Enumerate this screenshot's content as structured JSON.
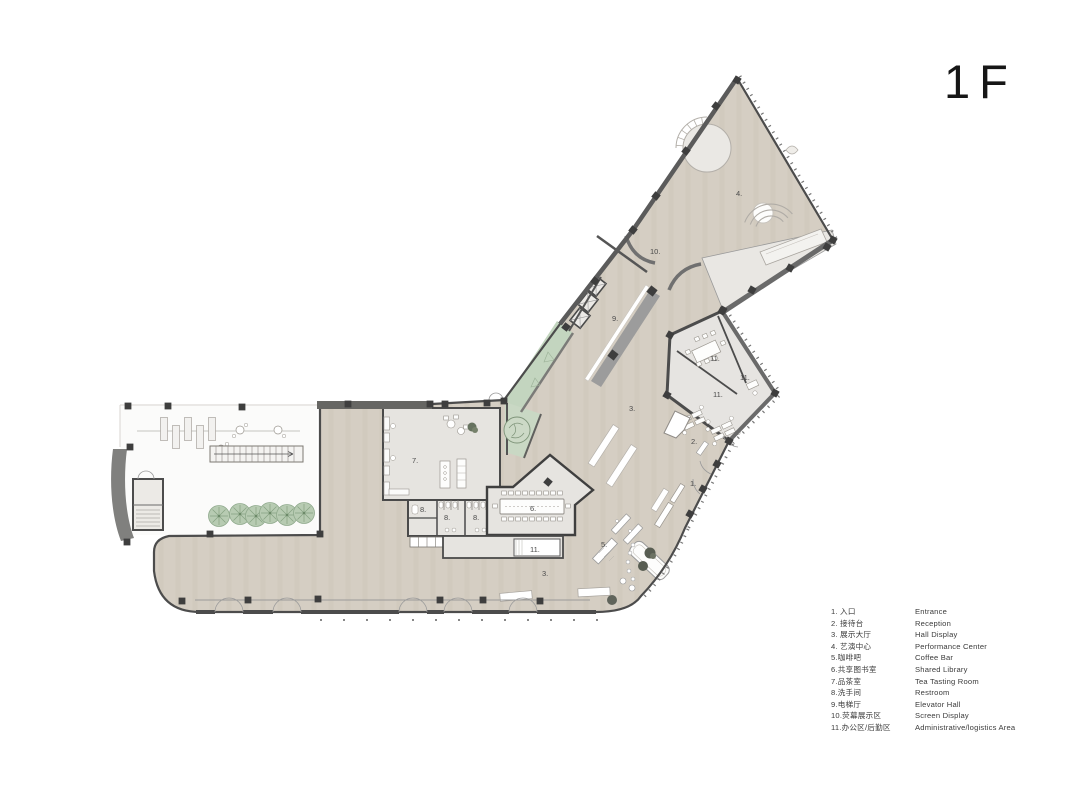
{
  "title": "1F",
  "legend": {
    "items": [
      {
        "cn": "1. 入口",
        "en": "Entrance"
      },
      {
        "cn": "2. 接待台",
        "en": "Reception"
      },
      {
        "cn": "3. 展示大厅",
        "en": "Hall Display"
      },
      {
        "cn": "4. 艺演中心",
        "en": "Performance Center"
      },
      {
        "cn": "5.咖啡吧",
        "en": "Coffee Bar"
      },
      {
        "cn": "6.共享图书室",
        "en": "Shared Library"
      },
      {
        "cn": "7.品茶室",
        "en": "Tea Tasting Room"
      },
      {
        "cn": "8.洗手间",
        "en": "Restroom"
      },
      {
        "cn": "9.电梯厅",
        "en": "Elevator Hall"
      },
      {
        "cn": "10.荧幕展示区",
        "en": "Screen Display"
      },
      {
        "cn": "11.办公区/后勤区",
        "en": "Administrative/logistics Area"
      }
    ]
  },
  "plan_labels": [
    {
      "text": "4."
    },
    {
      "text": "10."
    },
    {
      "text": "9."
    },
    {
      "text": "3."
    },
    {
      "text": "3."
    },
    {
      "text": "11."
    },
    {
      "text": "11."
    },
    {
      "text": "11."
    },
    {
      "text": "11."
    },
    {
      "text": "2."
    },
    {
      "text": "1."
    },
    {
      "text": "7."
    },
    {
      "text": "8."
    },
    {
      "text": "8."
    },
    {
      "text": "8."
    },
    {
      "text": "6."
    },
    {
      "text": "5."
    }
  ],
  "colors": {
    "floor_main": "#d5cec3",
    "floor_light": "#e6e4e0",
    "stage_light": "#e9e7e3",
    "green_strip": "#c3d5bf",
    "tree_green": "#b7cbb2",
    "wall_dark": "#4c4c4c",
    "wall_mid": "#6a6a6a",
    "ramp_gray": "#9c9c9c"
  }
}
